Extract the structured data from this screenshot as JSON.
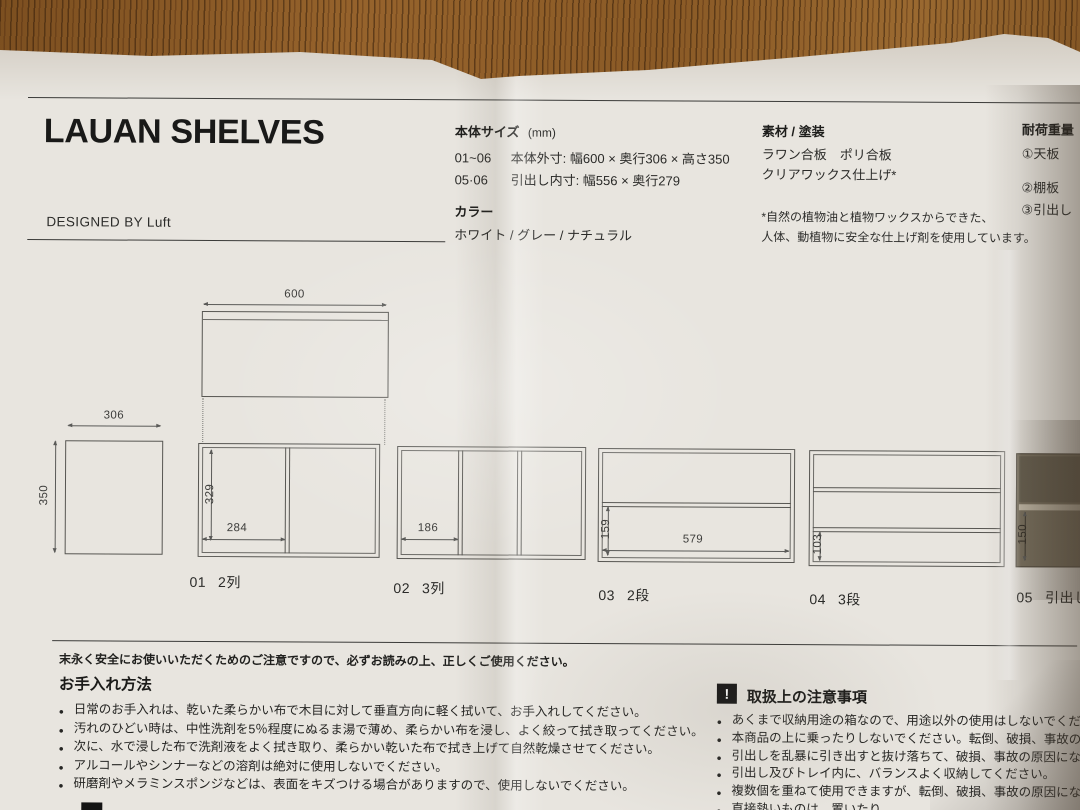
{
  "header": {
    "title": "LAUAN SHELVES",
    "designer": "DESIGNED BY Luft"
  },
  "specs": {
    "size_heading": "本体サイズ",
    "size_unit": "(mm)",
    "size_rows": [
      {
        "range": "01~06",
        "text": "本体外寸: 幅600 × 奥行306 × 高さ350"
      },
      {
        "range": "05·06",
        "text": "引出し内寸: 幅556 × 奥行279"
      }
    ],
    "color_heading": "カラー",
    "color_options": "ホワイト / グレー / ナチュラル"
  },
  "materials": {
    "heading": "素材 / 塗装",
    "line1": "ラワン合板　ポリ合板",
    "line2": "クリアワックス仕上げ*",
    "note1": "*自然の植物油と植物ワックスからできた、",
    "note2": "人体、動植物に安全な仕上げ剤を使用しています。"
  },
  "load": {
    "heading": "耐荷重量",
    "items": [
      "①天板",
      "②棚板",
      "③引出し"
    ]
  },
  "diagrams": {
    "top_view": {
      "width_label": "600"
    },
    "side_view": {
      "depth_label": "306",
      "height_label": "350"
    },
    "models": [
      {
        "id": "01",
        "label": "2列",
        "dim_v": "329",
        "dim_h": "284"
      },
      {
        "id": "02",
        "label": "3列",
        "dim_h": "186"
      },
      {
        "id": "03",
        "label": "2段",
        "dim_v": "159",
        "dim_h": "579"
      },
      {
        "id": "04",
        "label": "3段",
        "dim_v": "103"
      },
      {
        "id": "05",
        "label": "引出し",
        "dim_v": "150"
      }
    ]
  },
  "care": {
    "intro": "末永く安全にお使いいただくためのご注意ですので、必ずお読みの上、正しくご使用ください。",
    "heading": "お手入れ方法",
    "items": [
      "日常のお手入れは、乾いた柔らかい布で木目に対して垂直方向に軽く拭いて、お手入れしてください。",
      "汚れのひどい時は、中性洗剤を5％程度にぬるま湯で薄め、柔らかい布を浸し、よく絞って拭き取ってください。",
      "次に、水で浸した布で洗剤液をよく拭き取り、柔らかい乾いた布で拭き上げて自然乾燥させてください。",
      "アルコールやシンナーなどの溶剤は絶対に使用しないでください。",
      "研磨剤やメラミンスポンジなどは、表面をキズつける場合がありますので、使用しないでください。"
    ]
  },
  "handling": {
    "icon": "!",
    "heading": "取扱上の注意事項",
    "items": [
      "あくまで収納用途の箱なので、用途以外の使用はしないでください。",
      "本商品の上に乗ったりしないでください。転倒、破損、事故の原因になるこ",
      "引出しを乱暴に引き出すと抜け落ちて、破損、事故の原因になりますので、",
      "引出し及びトレイ内に、バランスよく収納してください。",
      "複数個を重ねて使用できますが、転倒、破損、事故の原因になりますので、",
      "直接熱いものは、置いたり"
    ]
  },
  "colors": {
    "paper": "#e8e5df",
    "wood": "#8a5a28",
    "ink": "#262624",
    "drawer_fill": "#78705f"
  }
}
